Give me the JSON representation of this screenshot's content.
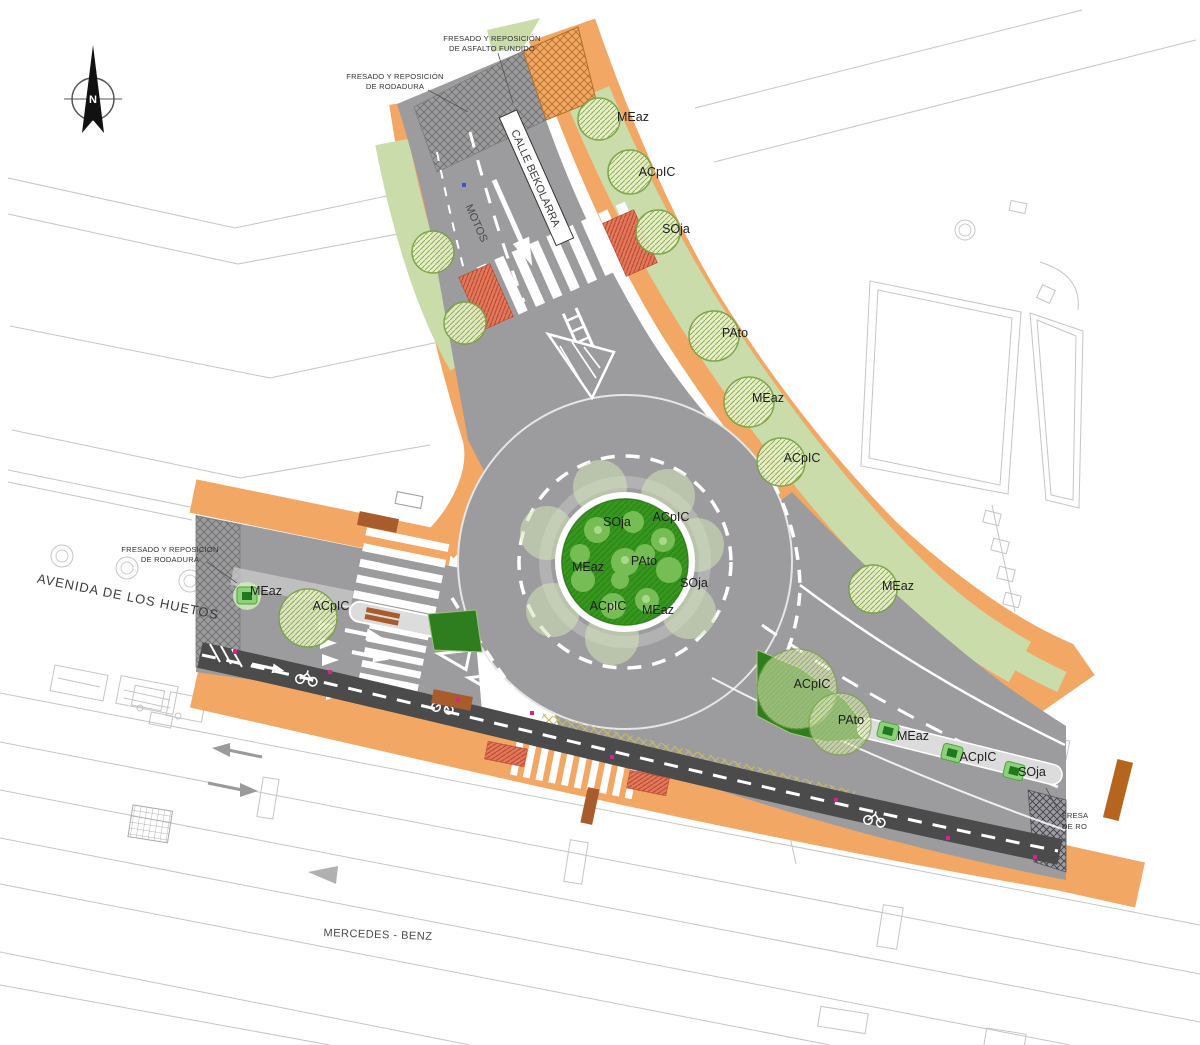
{
  "compass": {
    "letter": "N"
  },
  "annotations": {
    "asfalto_fundido": {
      "line1": "FRESADO Y REPOSICIÓN",
      "line2": "DE ASFALTO FUNDIDO"
    },
    "rodadura_top": {
      "line1": "FRESADO Y REPOSICIÓN",
      "line2": "DE RODADURA"
    },
    "rodadura_west": {
      "line1": "FRESADO Y REPOSICIÓN",
      "line2": "DE RODADURA"
    },
    "rodadura_clipped": {
      "line1": "FRESA",
      "line2": "DE RO"
    }
  },
  "streets": {
    "north_street": "CALLE BEKOLARRA",
    "motos_lane": "MOTOS",
    "west_avenue": "AVENIDA DE LOS HUETOS",
    "south_property": "MERCEDES - BENZ"
  },
  "trees": [
    {
      "species": "MEaz"
    },
    {
      "species": "ACpIC"
    },
    {
      "species": "SOja"
    },
    {
      "species": "PAto"
    },
    {
      "species": "MEaz"
    },
    {
      "species": "ACpIC"
    },
    {
      "species": "MEaz"
    },
    {
      "species": "MEaz"
    },
    {
      "species": "ACpIC"
    },
    {
      "species": "SOja"
    },
    {
      "species": "ACpIC"
    },
    {
      "species": "MEaz"
    },
    {
      "species": "PAto"
    },
    {
      "species": "SOja"
    },
    {
      "species": "ACpIC"
    },
    {
      "species": "MEaz"
    },
    {
      "species": "ACpIC"
    },
    {
      "species": "PAto"
    },
    {
      "species": "MEaz"
    },
    {
      "species": "ACpIC"
    },
    {
      "species": "SOja"
    }
  ],
  "colors": {
    "road": "#9c9c9e",
    "sidewalk": "#f2a765",
    "green_strip": "#c9dcaa",
    "island": "#36961e",
    "island_bush": "#7fc25c",
    "dark_lane": "#4b4b4b",
    "median": "#dcdcdc",
    "tactile": "#e2785e",
    "tactile_brown": "#a85b2b",
    "marker_pink": "#d6238f",
    "marker_blue": "#3a55cc",
    "hatch_yellow": "#c9b964",
    "tree_outline": "#76a043"
  }
}
